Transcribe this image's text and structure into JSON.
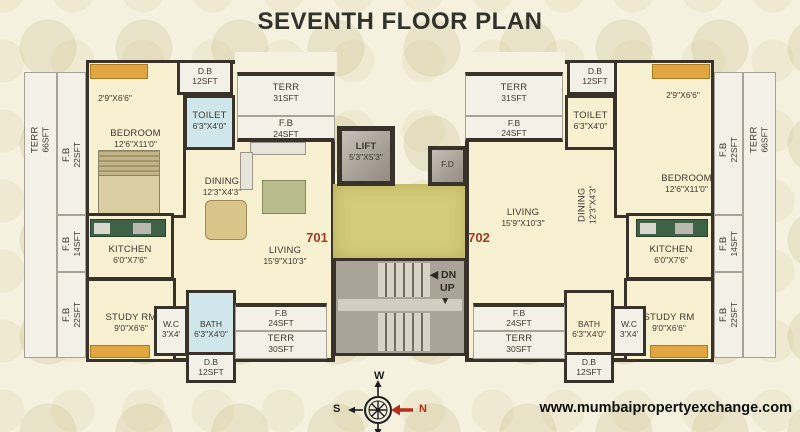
{
  "title": "SEVENTH FLOOR PLAN",
  "footer": {
    "website": "www.mumbaipropertyexchange.com"
  },
  "compass": {
    "west": "W",
    "south": "S",
    "north": "N"
  },
  "icons": {
    "left_arrow": "◀",
    "down_arrow": "▼"
  },
  "core": {
    "lift": {
      "name": "LIFT",
      "dim": "5'3\"X5'3\""
    },
    "fire_duct": "F.D",
    "stairs": {
      "down": "DN",
      "up": "UP"
    }
  },
  "unit_701": {
    "number": "701",
    "rooms": {
      "terr_side": {
        "name": "TERR",
        "area": "66SFT"
      },
      "fb_side_top": {
        "name": "F.B",
        "area": "22SFT"
      },
      "fb_side_mid": {
        "name": "F.B",
        "area": "14SFT"
      },
      "fb_side_bottom": {
        "name": "F.B",
        "area": "22SFT"
      },
      "balcony_dim": "2'9\"X6'6\"",
      "bedroom": {
        "name": "BEDROOM",
        "dim": "12'6\"X11'0\""
      },
      "db_top": {
        "name": "D.B",
        "area": "12SFT"
      },
      "toilet": {
        "name": "TOILET",
        "dim": "6'3\"X4'0\""
      },
      "dining": {
        "name": "DINING",
        "dim": "12'3\"X4'3\""
      },
      "kitchen": {
        "name": "KITCHEN",
        "dim": "6'0\"X7'6\""
      },
      "living": {
        "name": "LIVING",
        "dim": "15'9\"X10'3\""
      },
      "study": {
        "name": "STUDY RM",
        "dim": "9'0\"X6'6\""
      },
      "wc": {
        "name": "W.C",
        "dim": "3'X4'"
      },
      "bath": {
        "name": "BATH",
        "dim": "6'3\"X4'0\""
      },
      "db_bottom": {
        "name": "D.B",
        "area": "12SFT"
      },
      "terr_top": {
        "name": "TERR",
        "area": "31SFT"
      },
      "fb_top": {
        "name": "F.B",
        "area": "24SFT"
      },
      "fb_bottom": {
        "name": "F.B",
        "area": "24SFT"
      },
      "terr_bottom": {
        "name": "TERR",
        "area": "30SFT"
      }
    }
  },
  "unit_702": {
    "number": "702",
    "rooms": {
      "terr_side": {
        "name": "TERR",
        "area": "66SFT"
      },
      "fb_side_top": {
        "name": "F.B",
        "area": "22SFT"
      },
      "fb_side_mid": {
        "name": "F.B",
        "area": "14SFT"
      },
      "fb_side_bottom": {
        "name": "F.B",
        "area": "22SFT"
      },
      "balcony_dim": "2'9\"X6'6\"",
      "bedroom": {
        "name": "BEDROOM",
        "dim": "12'6\"X11'0\""
      },
      "db_top": {
        "name": "D.B",
        "area": "12SFT"
      },
      "toilet": {
        "name": "TOILET",
        "dim": "6'3\"X4'0\""
      },
      "dining": {
        "name": "DINING",
        "dim": "12'3\"X4'3\""
      },
      "kitchen": {
        "name": "KITCHEN",
        "dim": "6'0\"X7'6\""
      },
      "living": {
        "name": "LIVING",
        "dim": "15'9\"X10'3\""
      },
      "study": {
        "name": "STUDY RM",
        "dim": "9'0\"X6'6\""
      },
      "wc": {
        "name": "W.C",
        "dim": "3'X4'"
      },
      "bath": {
        "name": "BATH",
        "dim": "6'3\"X4'0\""
      },
      "db_bottom": {
        "name": "D.B",
        "area": "12SFT"
      },
      "terr_top": {
        "name": "TERR",
        "area": "31SFT"
      },
      "fb_top": {
        "name": "F.B",
        "area": "24SFT"
      },
      "fb_bottom": {
        "name": "F.B",
        "area": "24SFT"
      },
      "terr_bottom": {
        "name": "TERR",
        "area": "30SFT"
      }
    }
  }
}
